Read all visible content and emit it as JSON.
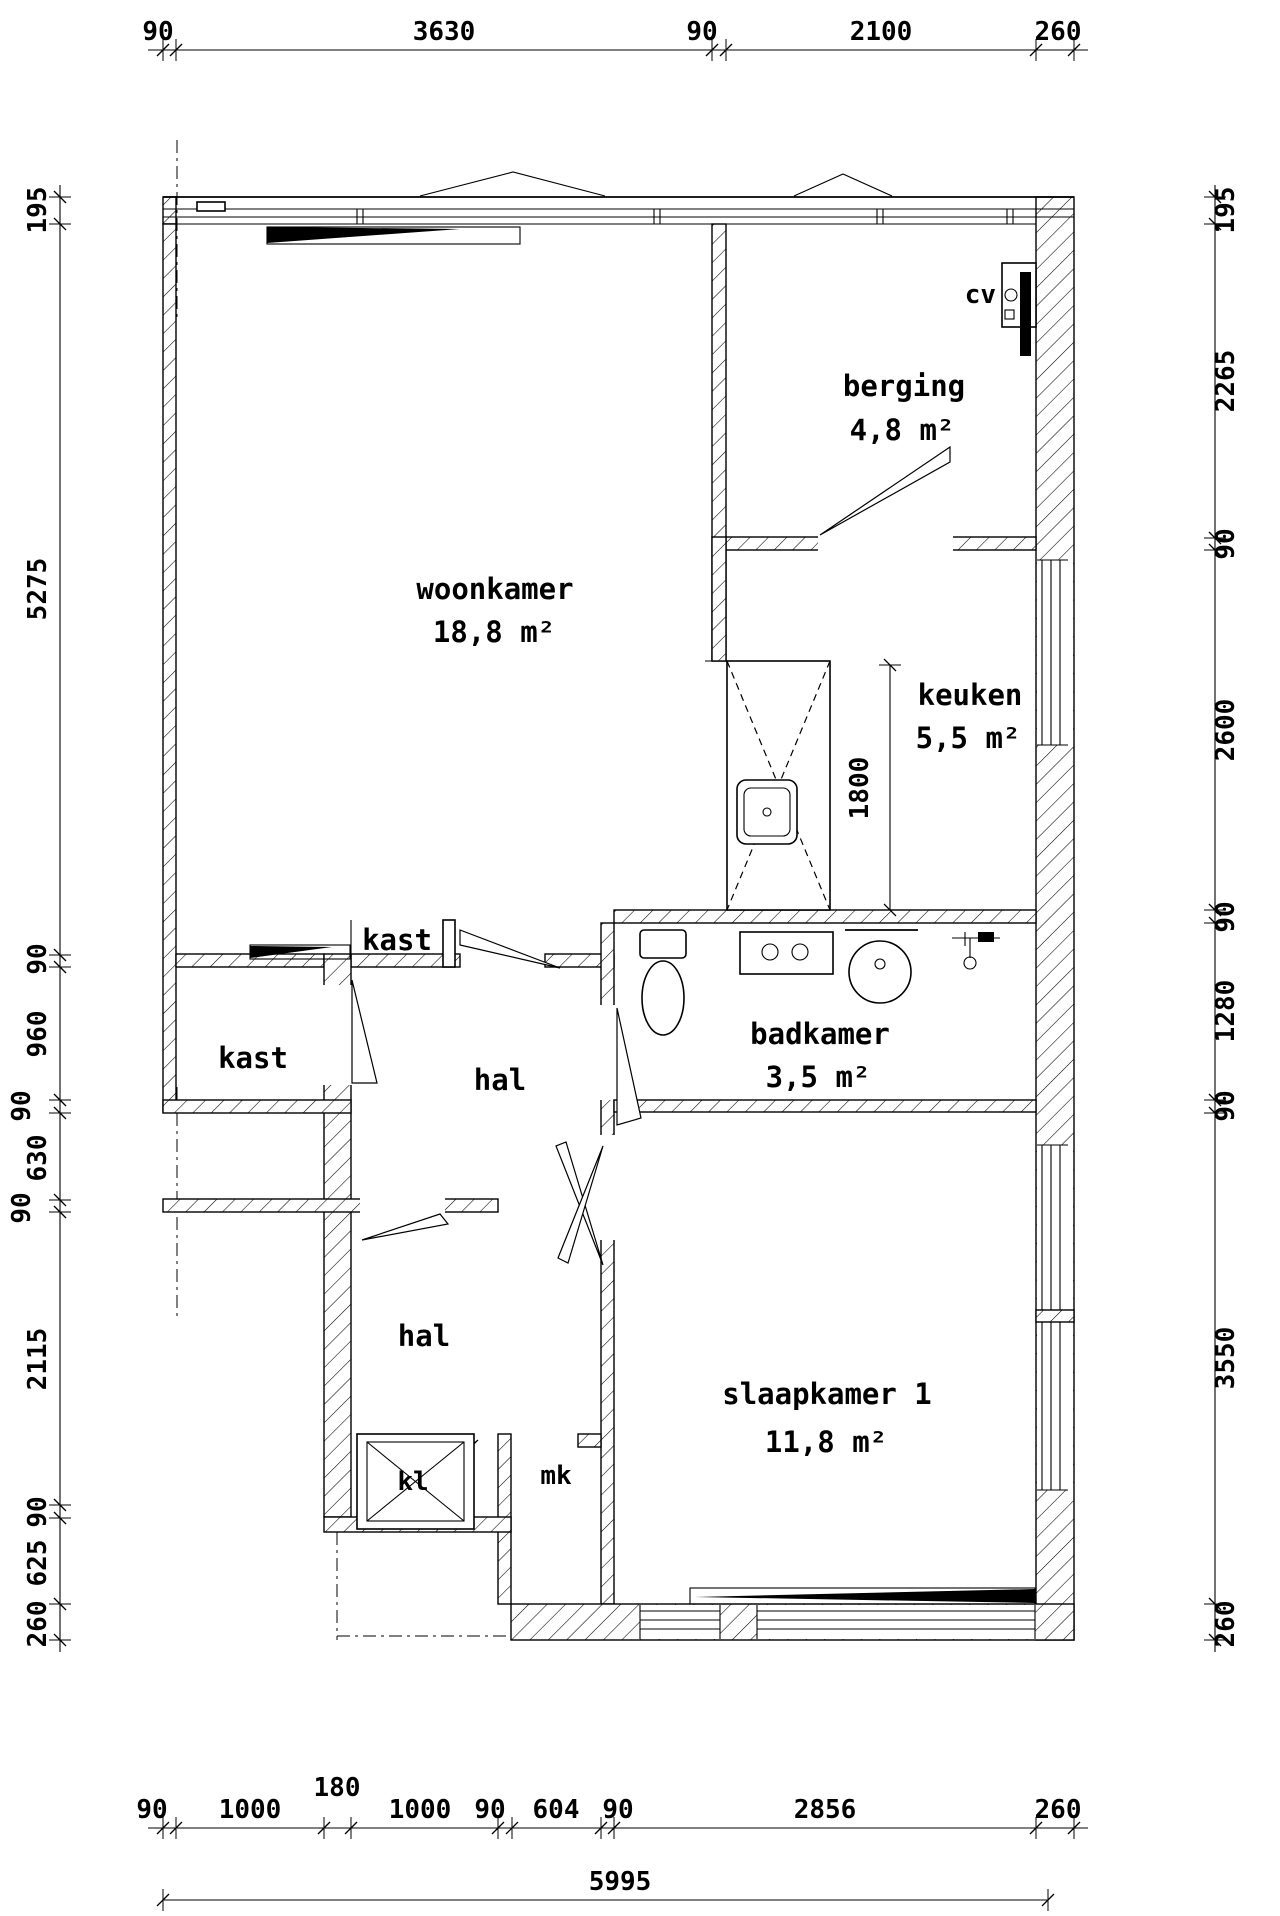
{
  "drawing": {
    "type": "floor-plan",
    "language": "nl",
    "colors": {
      "line": "#000000",
      "background": "#ffffff"
    }
  },
  "rooms": {
    "woonkamer": {
      "name": "woonkamer",
      "area": "18,8 m²"
    },
    "berging": {
      "name": "berging",
      "area": "4,8 m²"
    },
    "keuken": {
      "name": "keuken",
      "area": "5,5 m²"
    },
    "badkamer": {
      "name": "badkamer",
      "area": "3,5 m²"
    },
    "slaapkamer": {
      "name": "slaapkamer 1",
      "area": "11,8 m²"
    },
    "hal_boven": {
      "name": "hal"
    },
    "hal_onder": {
      "name": "hal"
    },
    "kast_boven": {
      "name": "kast"
    },
    "kast_links": {
      "name": "kast"
    },
    "kl": {
      "name": "kl"
    },
    "mk": {
      "name": "mk"
    },
    "cv": {
      "name": "cv"
    }
  },
  "dims": {
    "top": [
      "90",
      "3630",
      "90",
      "2100",
      "260"
    ],
    "left": [
      "195",
      "5275",
      "90",
      "960",
      "90",
      "630",
      "90",
      "2115",
      "90",
      "625",
      "260"
    ],
    "right": [
      "195",
      "2265",
      "90",
      "2600",
      "90",
      "1280",
      "90",
      "3550",
      "260"
    ],
    "bottom": [
      "90",
      "1000",
      "180",
      "1000",
      "90",
      "604",
      "90",
      "2856",
      "260"
    ],
    "bottom_total": "5995",
    "keuken_opening": "1800"
  }
}
